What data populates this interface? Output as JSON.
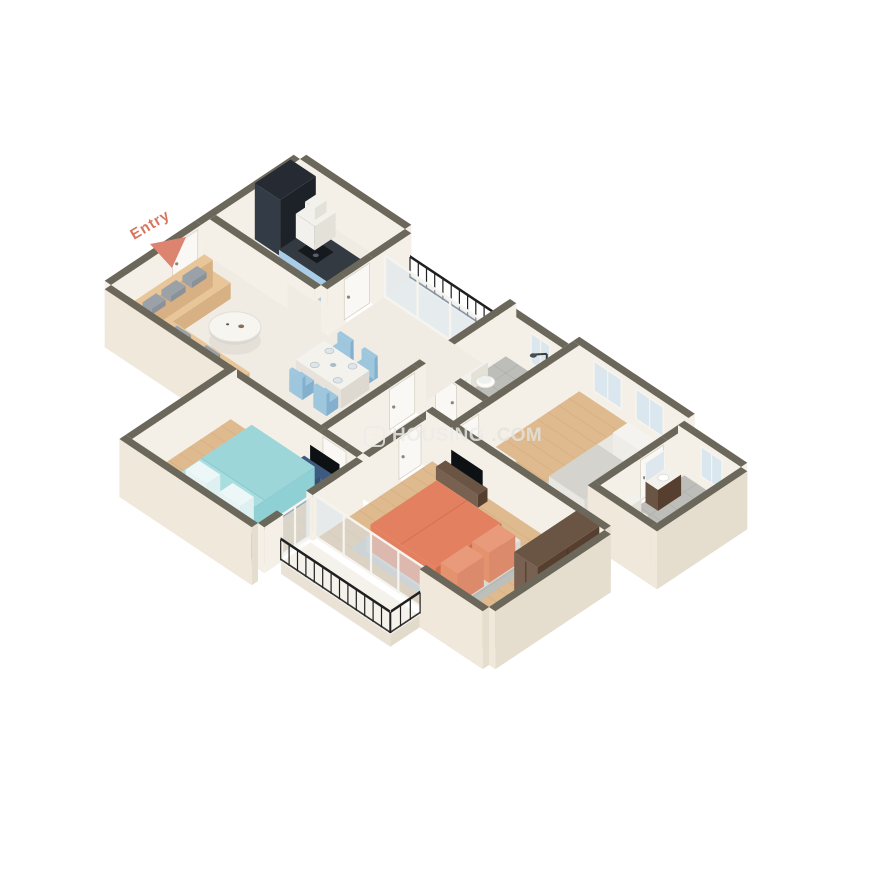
{
  "entry": {
    "label": "Entry"
  },
  "watermark": {
    "brand": "HOUSING",
    "tld": ".COM",
    "icon": "house-icon"
  },
  "palette": {
    "background": "#ffffff",
    "entryText": "#d8755c",
    "entryArrow": "#dd8471",
    "watermarkText": "#ececea",
    "watermarkDim": "#e4e3df",
    "wallCap": "#6b675a",
    "wallIn": "#f5f0e7",
    "wallExtL": "#efe8db",
    "wallExtR": "#e5ddcd",
    "marble": "#f1ece3",
    "balconyFloor": "#f5f2ec",
    "wood": "#deba8e",
    "woodLine": "#cda57a",
    "tile": "#bdbdb9",
    "tileLine": "#abaaa5",
    "door": "#faf8f4",
    "doorEdge": "#d8d2c6",
    "knob": "#8d8779",
    "glass": "#d9e6ee",
    "frame": "#f6f4ef",
    "railing": "#202020",
    "cabinetBlue": "#a9cde6",
    "cabinetBlueDark": "#93beda",
    "counterTop": "#343a41",
    "appliance": "#262b33",
    "applianceDark": "#1d2228",
    "applianceLight": "#333b47",
    "stove": "#16191d",
    "chairBlue": "#9ec7de",
    "chairBlueDark": "#84b0cd",
    "navy": "#3d5a80",
    "navyDark": "#32506f",
    "navyLight": "#46689a",
    "cyan": "#a9dee1",
    "cyanDark": "#8fd0d4",
    "cyanDuvet": "#9cd6d9",
    "pillowWhite": "#eef7f7",
    "coral": "#e2805f",
    "coralDark": "#d06f50",
    "coralLight": "#e99a7b",
    "tan": "#e8c69a",
    "tanDark": "#d7b083",
    "pillowGray": "#9aa1a8",
    "pillowGrayDark": "#8a9199",
    "white": "#f3f1ec",
    "whiteDark": "#e4e1d9",
    "brown": "#6a5444",
    "brownDark": "#573f2f",
    "brownLight": "#786150",
    "rug": "#bcbfba",
    "bedGray": "#c7cac6",
    "bedGrayDark": "#b7bab6",
    "mattress": "#e9e7e1",
    "mattressDark": "#dbd9d3",
    "tv": "#0e1114",
    "doormat": "#d9b98c"
  }
}
